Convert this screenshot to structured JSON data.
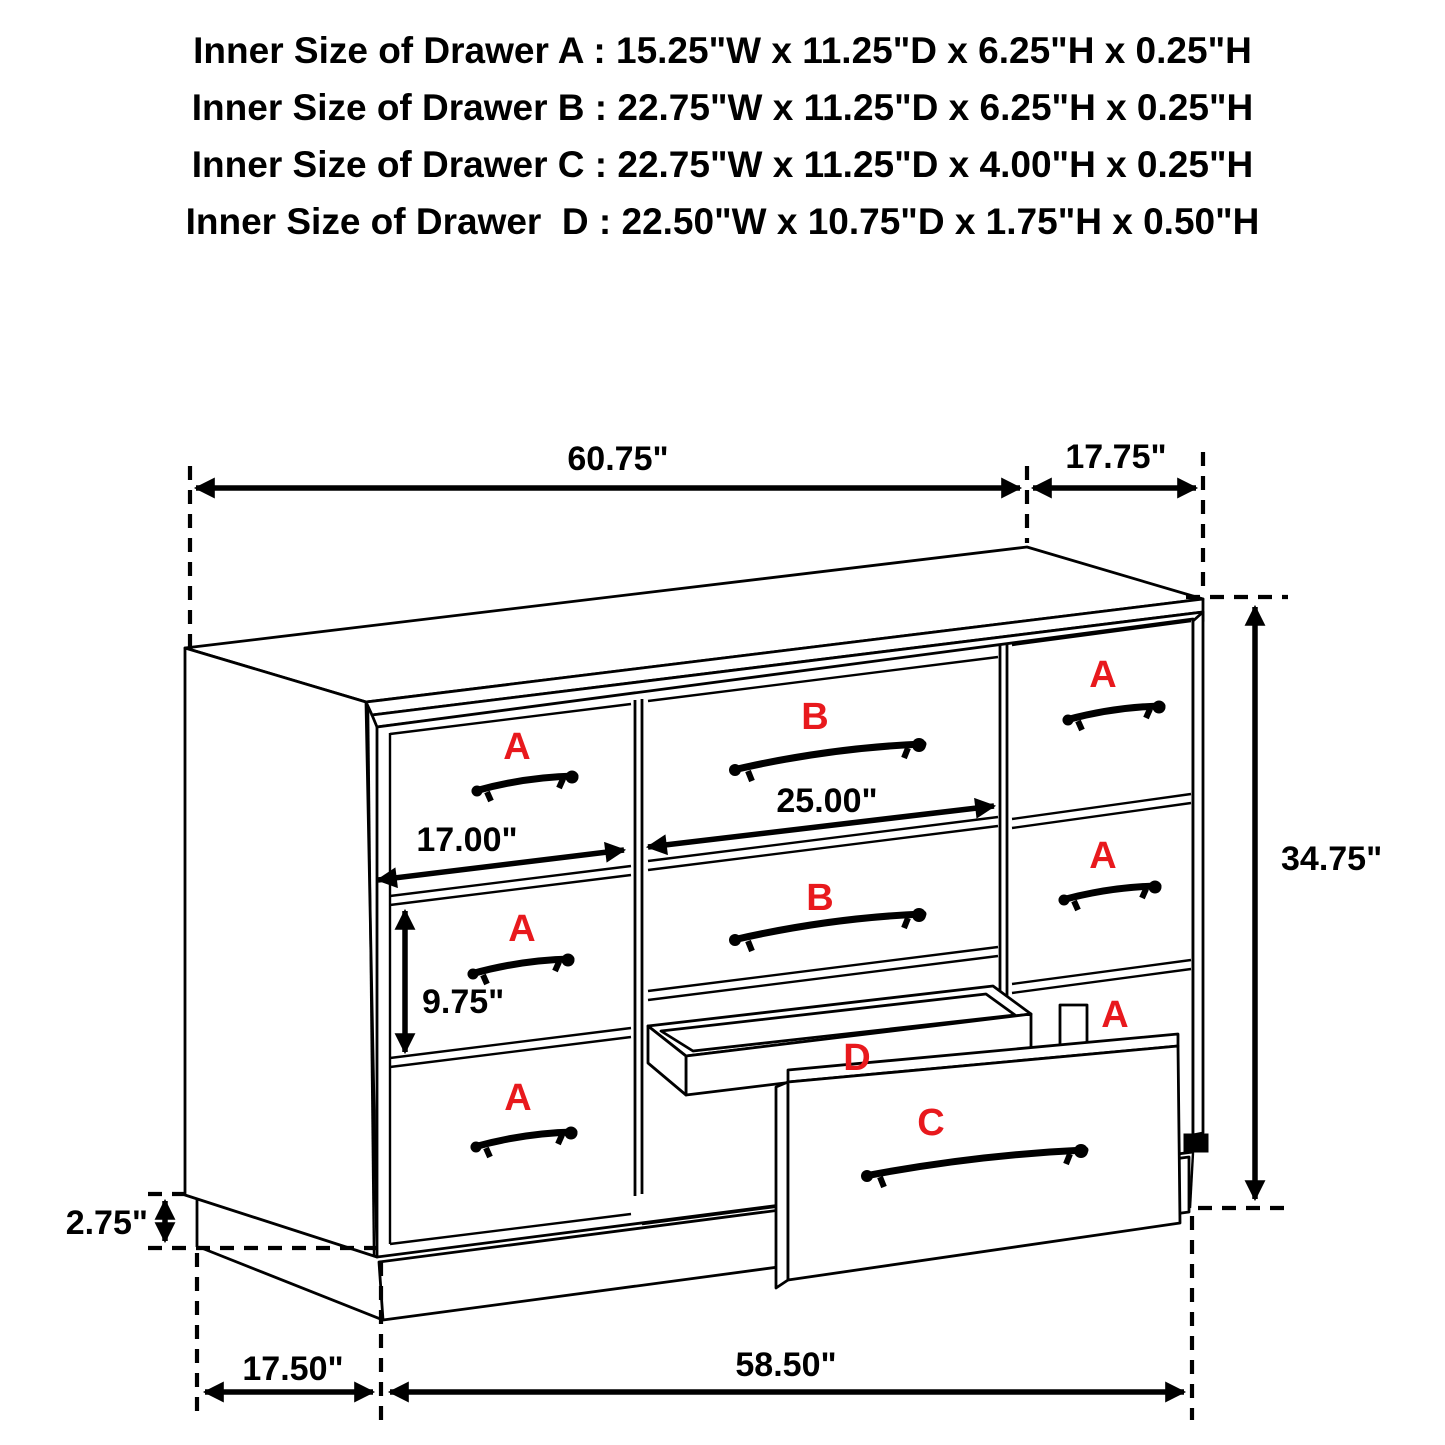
{
  "title_lines": [
    "Inner Size of Drawer A : 15.25\"W x 11.25\"D x 6.25\"H x 0.25\"H",
    "Inner Size of Drawer B : 22.75\"W x 11.25\"D x 6.25\"H x 0.25\"H",
    "Inner Size of Drawer C : 22.75\"W x 11.25\"D x 4.00\"H x 0.25\"H",
    "Inner Size of Drawer  D : 22.50\"W x 10.75\"D x 1.75\"H x 0.50\"H"
  ],
  "diagram": {
    "dimensions": {
      "top_width": "60.75\"",
      "top_depth": "17.75\"",
      "overall_height": "34.75\"",
      "middle_drawer_width": "25.00\"",
      "left_drawer_width": "17.00\"",
      "left_drawer_height": "9.75\"",
      "base_height": "2.75\"",
      "base_side_depth": "17.50\"",
      "base_front_width": "58.50\""
    },
    "drawer_letters": {
      "a": "A",
      "b": "B",
      "c": "C",
      "d": "D"
    },
    "colors": {
      "line": "#000000",
      "label_red": "#e8191d",
      "background": "#ffffff"
    }
  }
}
